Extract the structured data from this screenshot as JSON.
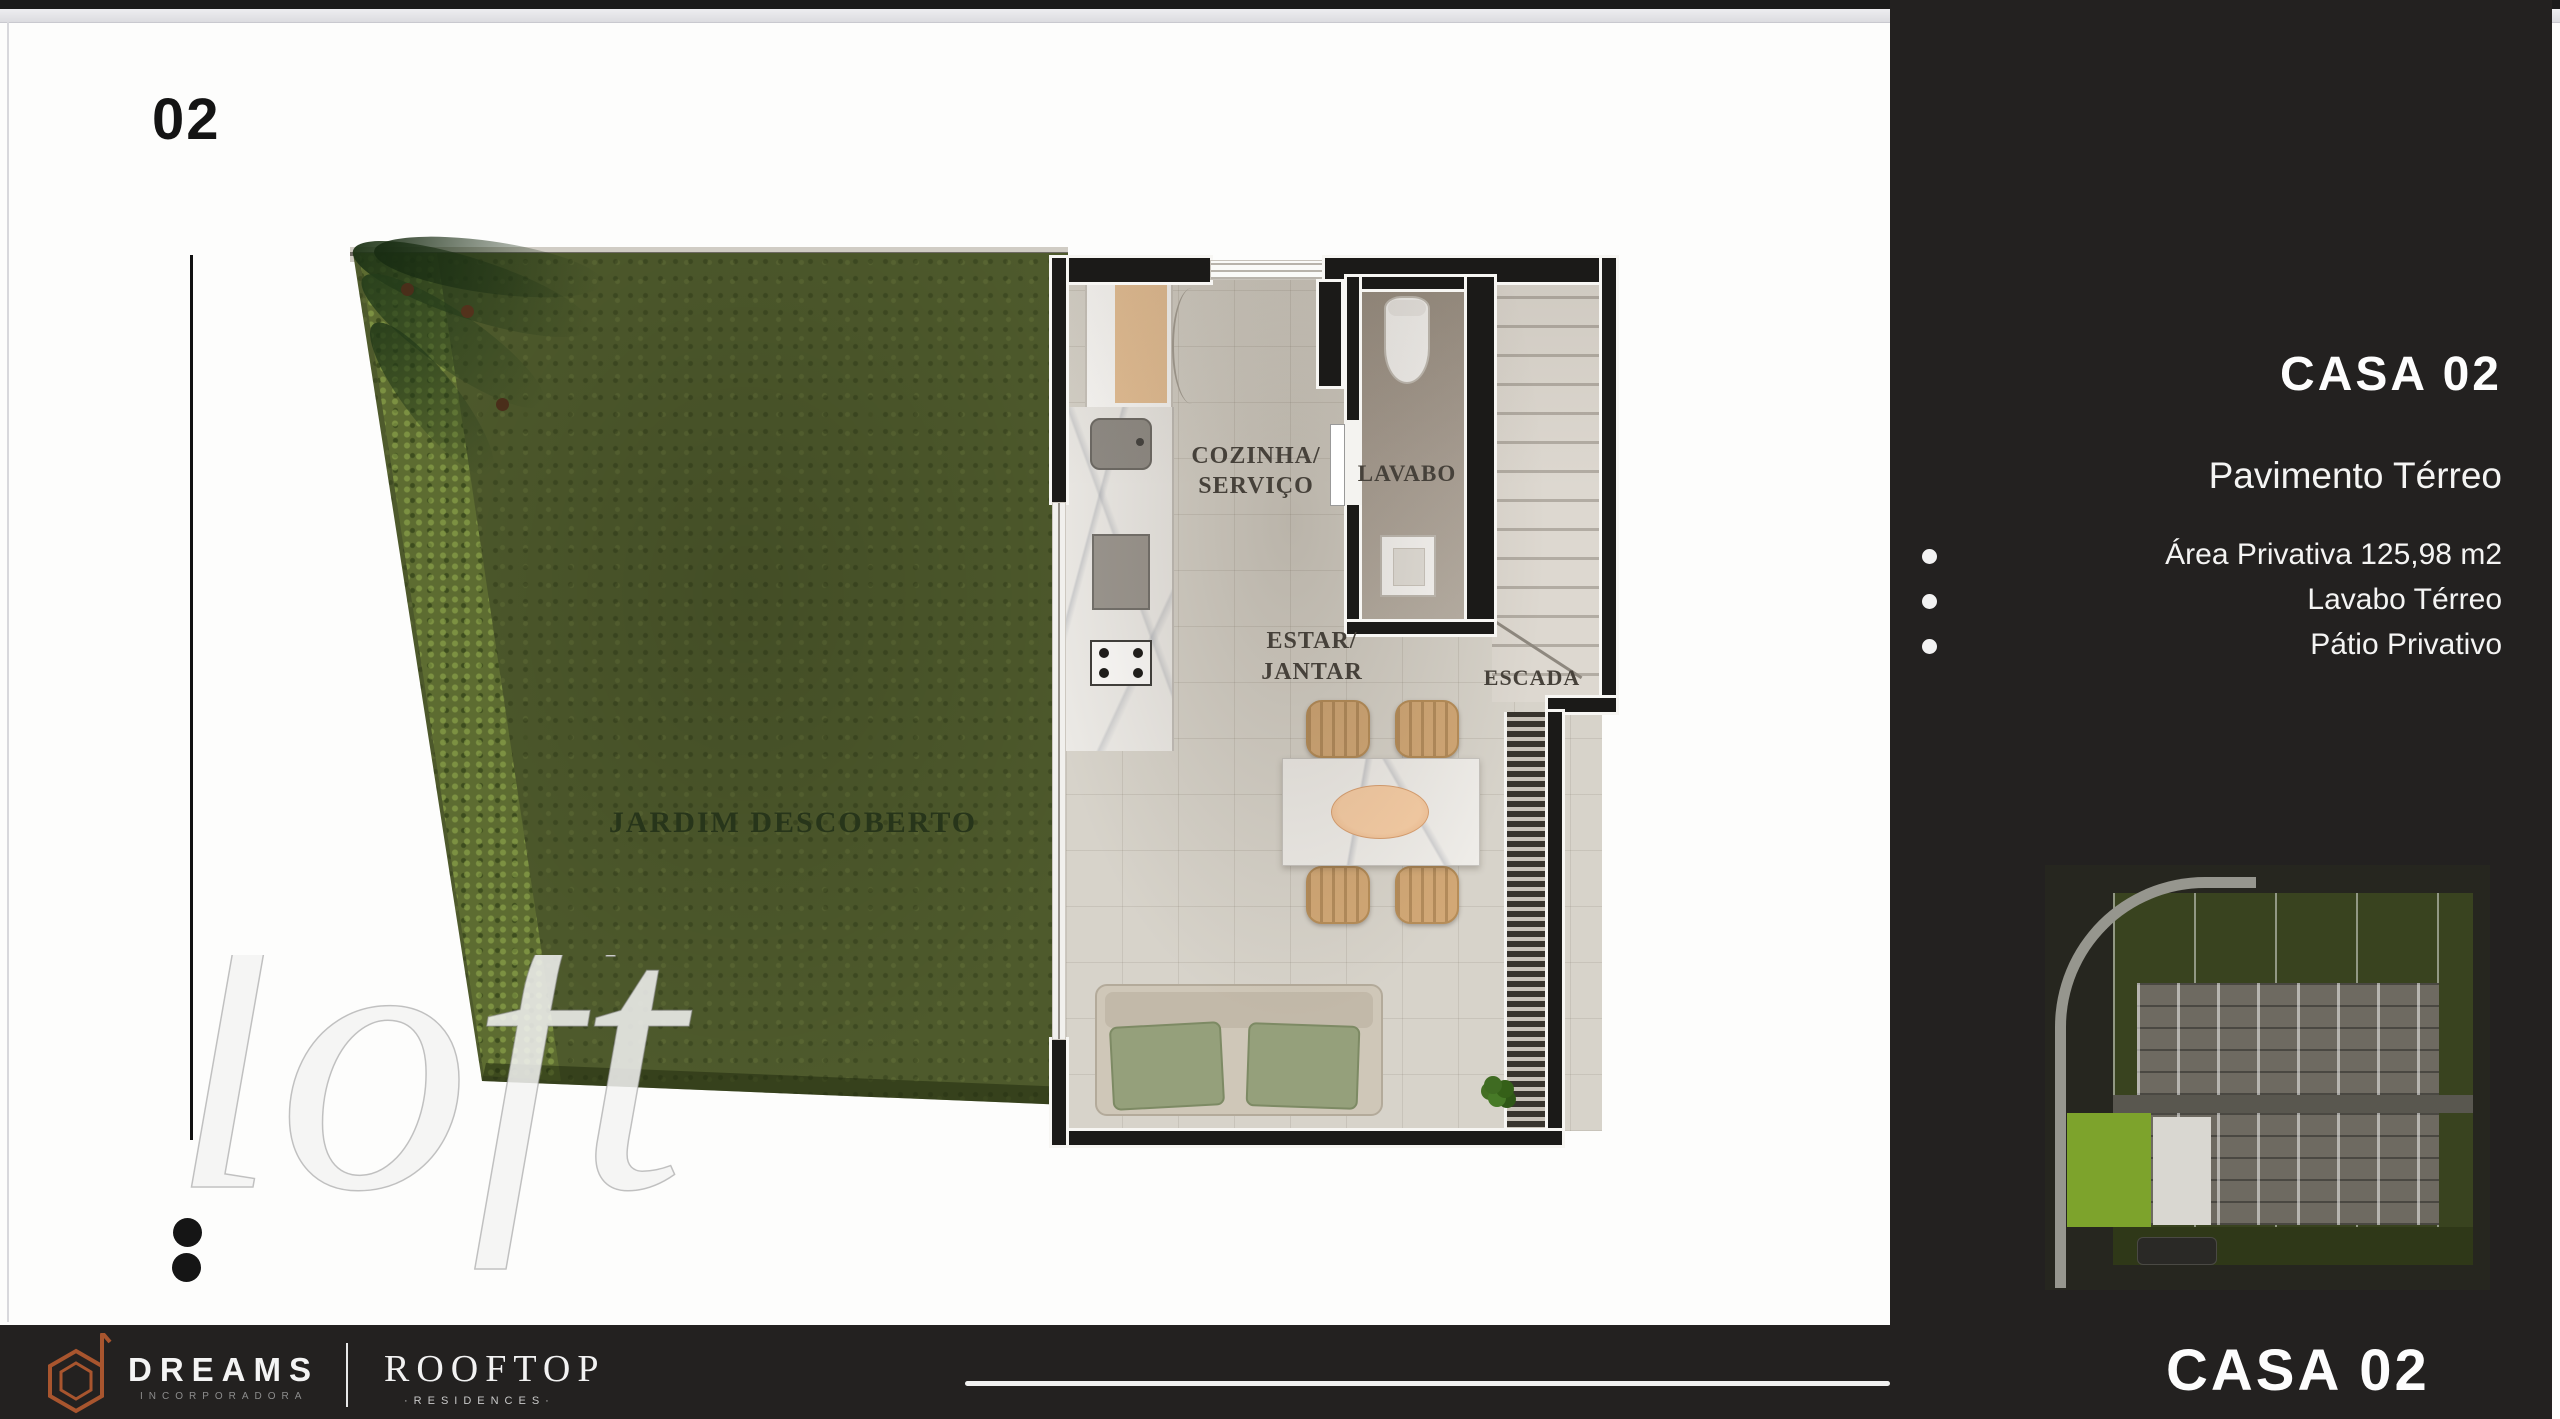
{
  "slide": {
    "number": "02"
  },
  "plan": {
    "garden_label": "JARDIM DESCOBERTO",
    "kitchen_label_line1": "COZINHA/",
    "kitchen_label_line2": "SERVIÇO",
    "lavabo_label": "LAVABO",
    "living_label_line1": "ESTAR/",
    "living_label_line2": "JANTAR",
    "stairs_label": "ESCADA"
  },
  "sidebar": {
    "title": "CASA 02",
    "subtitle": "Pavimento Térreo",
    "features": [
      {
        "label": "Área Privativa 125,98 m2"
      },
      {
        "label": "Lavabo Térreo"
      },
      {
        "label": "Pátio Privativo"
      }
    ],
    "bottom_title": "CASA 02"
  },
  "footer": {
    "brand": "DREAMS",
    "brand_sub": "INCORPORADORA",
    "project": "ROOFTOP",
    "project_sub": "·RESIDENCES·"
  },
  "watermark": "loft",
  "icons": {
    "bullet": "filled-circle",
    "dreams_logo": "hexagon-d-monogram"
  },
  "colors": {
    "sidebar_bg": "#232120",
    "accent_copper": "#a8552e",
    "grass_green": "#4e5a2c",
    "highlight_green": "#7da32c",
    "wall_black": "#1b1a18",
    "tile_floor": "#d7d3ca"
  }
}
